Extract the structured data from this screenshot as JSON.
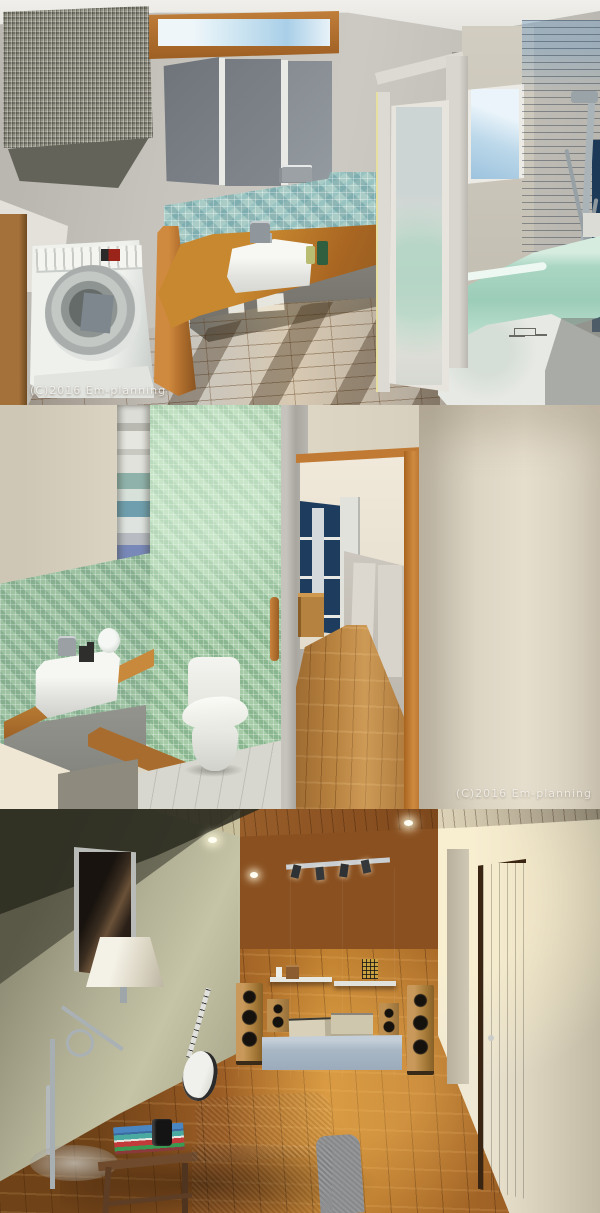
{
  "watermark": {
    "text": "(C)2016 Em-planning"
  },
  "panels": [
    {
      "name": "bathroom-laundry-render"
    },
    {
      "name": "toilet-room-render"
    },
    {
      "name": "audio-listening-room-render"
    }
  ],
  "palette": {
    "wall_gray": "#c6c3bc",
    "wall_cream": "#dcd4c2",
    "wall_olive": "#a7a58c",
    "mosaic_teal": "#a9cdc6",
    "mosaic_green": "#a4cba6",
    "bathroom_blue_tile": "#1e4e7c",
    "audio_accent_blue": "#1d5b7c",
    "bathtub_mint": "#a9d6c3",
    "counter_wood": "#b5722f",
    "floor_wood": "#a97a38",
    "ceiling_wood": "#96672f"
  }
}
